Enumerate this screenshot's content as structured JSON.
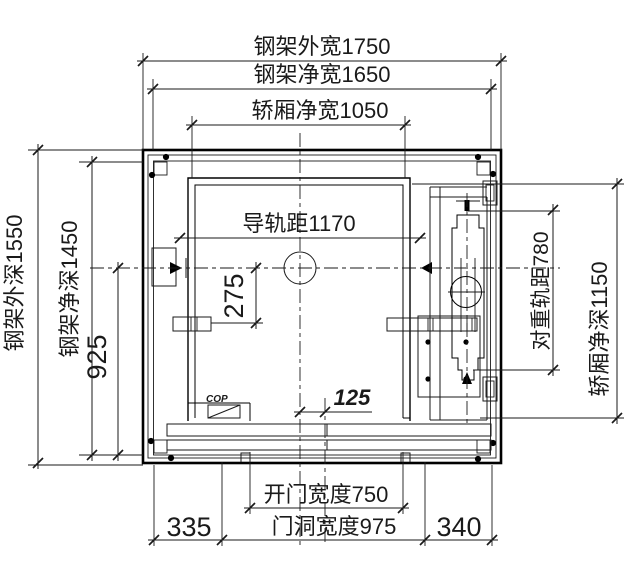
{
  "drawing": {
    "kind": "elevator-shaft-plan",
    "colors": {
      "line": "#1a1a1a",
      "background": "#ffffff"
    }
  },
  "dims": {
    "frame_outer_width": "钢架外宽1750",
    "frame_net_width": "钢架净宽1650",
    "car_net_width": "轿厢净宽1050",
    "guide_rail_span": "导轨距1170",
    "frame_outer_depth": "钢架外深1550",
    "frame_net_depth": "钢架净深1450",
    "center_to_bracket": "925",
    "center_offset": "275",
    "door_center_offset": "125",
    "cw_rail_span": "对重轨距780",
    "car_net_depth": "轿厢净深1150",
    "door_open_width": "开门宽度750",
    "door_hole_width": "门洞宽度975",
    "left_margin": "335",
    "right_margin": "340"
  },
  "annotations": {
    "cop": "COP"
  }
}
